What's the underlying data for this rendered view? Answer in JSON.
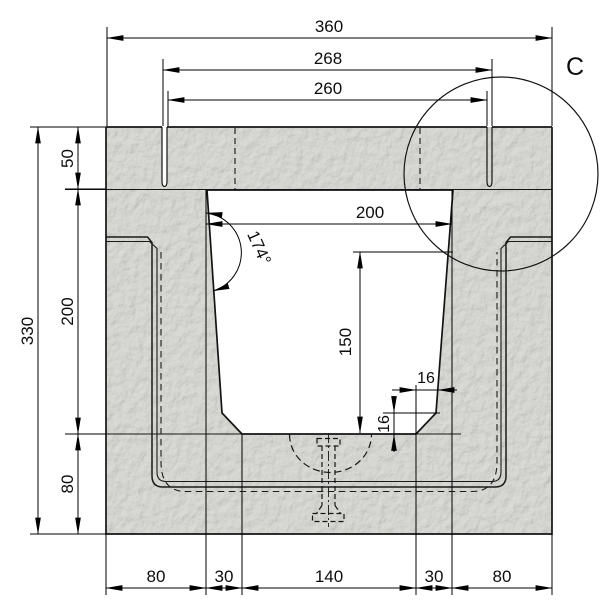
{
  "drawing": {
    "title": "concrete-channel-cross-section",
    "detail_label": "C",
    "dimensions": {
      "top": {
        "overall_width": "360",
        "cover_seat_width": "268",
        "cover_width": "260"
      },
      "left": {
        "overall_height": "330",
        "cover_thickness": "50",
        "channel_depth": "200",
        "base_thickness": "80"
      },
      "inner": {
        "clear_width": "200",
        "wall_angle": "174°",
        "depth_to_chamfer": "150",
        "chamfer_width": "16",
        "chamfer_height": "16"
      },
      "bottom": {
        "segments": [
          "80",
          "30",
          "140",
          "30",
          "80"
        ]
      }
    },
    "colors": {
      "line": "#161616",
      "dimension_line": "#000000",
      "concrete_fill": "#d4d4d0",
      "background": "#ffffff"
    }
  }
}
